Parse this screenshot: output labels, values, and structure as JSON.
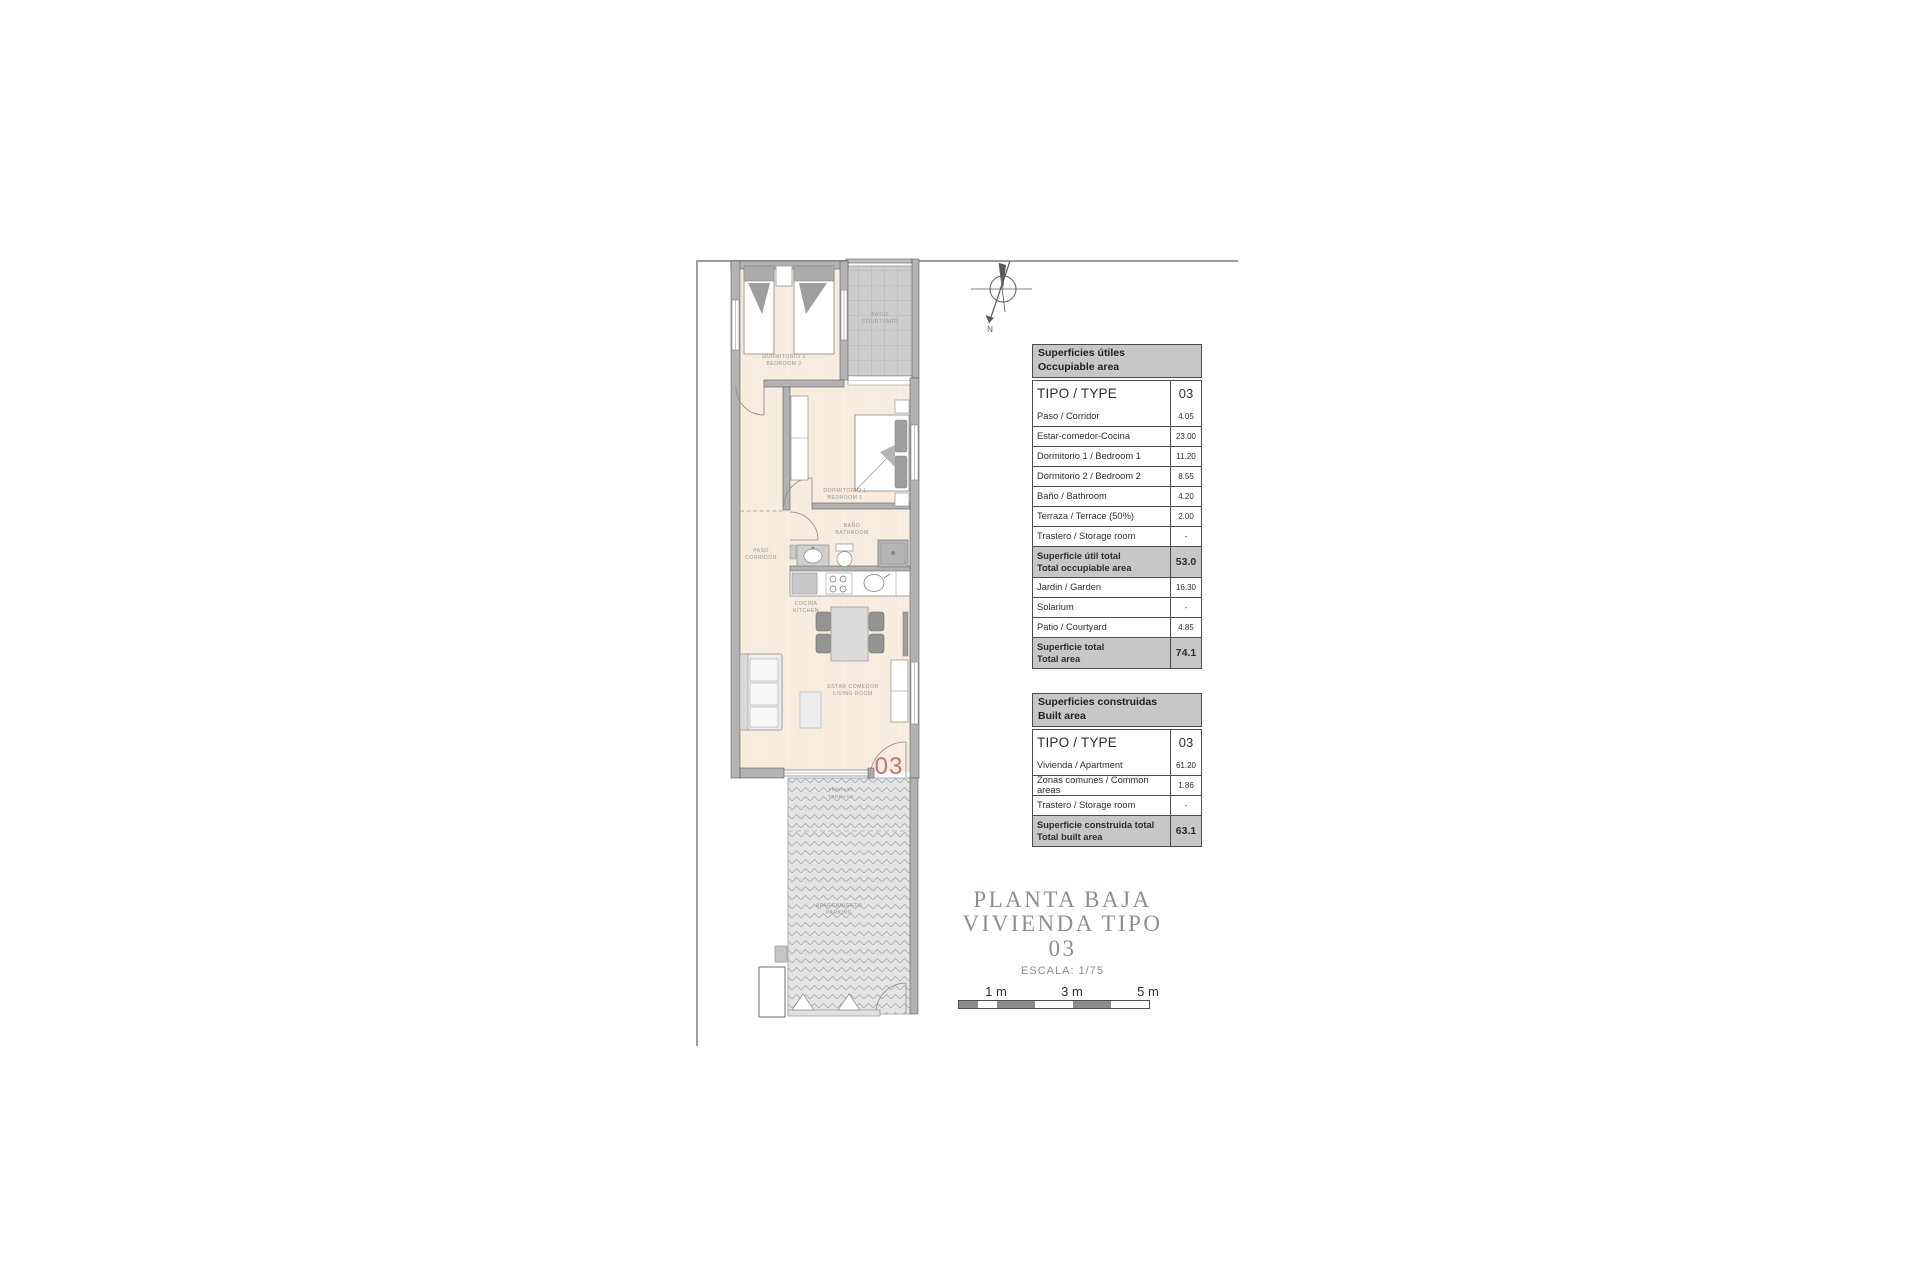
{
  "colors": {
    "accent_red": "#c4756c",
    "table_header_gray": "#c7c7c7",
    "wall_gray": "#b2b2b2",
    "floor_cream": "#f6ecdf"
  },
  "plan": {
    "unit_number": "03",
    "compass": "N",
    "rooms": {
      "bedroom2": [
        "DORMITORIO 2",
        "BEDROOM 2"
      ],
      "patio": [
        "PATIO",
        "COURTYARD"
      ],
      "bedroom1": [
        "DORMITORIO 1",
        "BEDROOM 1"
      ],
      "bathroom": [
        "BAÑO",
        "BATHROOM"
      ],
      "corridor": [
        "PASO",
        "CORRIDOR"
      ],
      "kitchen": [
        "COCINA",
        "KITCHEN"
      ],
      "living": [
        "ESTAR COMEDOR",
        "LIVING ROOM"
      ],
      "terrace": [
        "TERRAZA",
        "TERRACE"
      ],
      "parking": [
        "APARCAMIENTO",
        "PARKING"
      ]
    }
  },
  "tables": {
    "occupiable": {
      "header": [
        "Superficies útiles",
        "Occupiable area"
      ],
      "type_row": {
        "label": "TIPO / TYPE",
        "value": "03"
      },
      "rows": [
        {
          "label": "Paso / Corridor",
          "value": "4.05"
        },
        {
          "label": "Estar-comedor-Cocina",
          "value": "23.00"
        },
        {
          "label": "Dormitorio 1 / Bedroom 1",
          "value": "11.20"
        },
        {
          "label": "Dormitorio 2 / Bedroom 2",
          "value": "8.55"
        },
        {
          "label": "Baño / Bathroom",
          "value": "4.20"
        },
        {
          "label": "Terraza / Terrace (50%)",
          "value": "2.00"
        },
        {
          "label": "Trastero / Storage room",
          "value": "-"
        },
        {
          "lines": [
            "Superficie útil total",
            "Total occupiable area"
          ],
          "value": "53.0",
          "total": true
        },
        {
          "label": "Jardin / Garden",
          "value": "16.30"
        },
        {
          "label": "Solarium",
          "value": "-"
        },
        {
          "label": "Patio / Courtyard",
          "value": "4.85"
        },
        {
          "lines": [
            "Superficie total",
            "Total area"
          ],
          "value": "74.1",
          "total": true
        }
      ]
    },
    "built": {
      "header": [
        "Superficies construidas",
        "Built area"
      ],
      "type_row": {
        "label": "TIPO / TYPE",
        "value": "03"
      },
      "rows": [
        {
          "label": "Vivienda / Apartment",
          "value": "61.20"
        },
        {
          "label": "Zonas comunes / Common areas",
          "value": "1.86"
        },
        {
          "label": "Trastero / Storage room",
          "value": "-"
        },
        {
          "lines": [
            "Superficie construida total",
            "Total built area"
          ],
          "value": "63.1",
          "total": true
        }
      ]
    }
  },
  "title": {
    "line1": "PLANTA BAJA",
    "line2": "VIVIENDA TIPO 03",
    "scale": "ESCALA: 1/75"
  },
  "scalebar": {
    "labels": [
      "1 m",
      "3 m",
      "5 m"
    ]
  }
}
